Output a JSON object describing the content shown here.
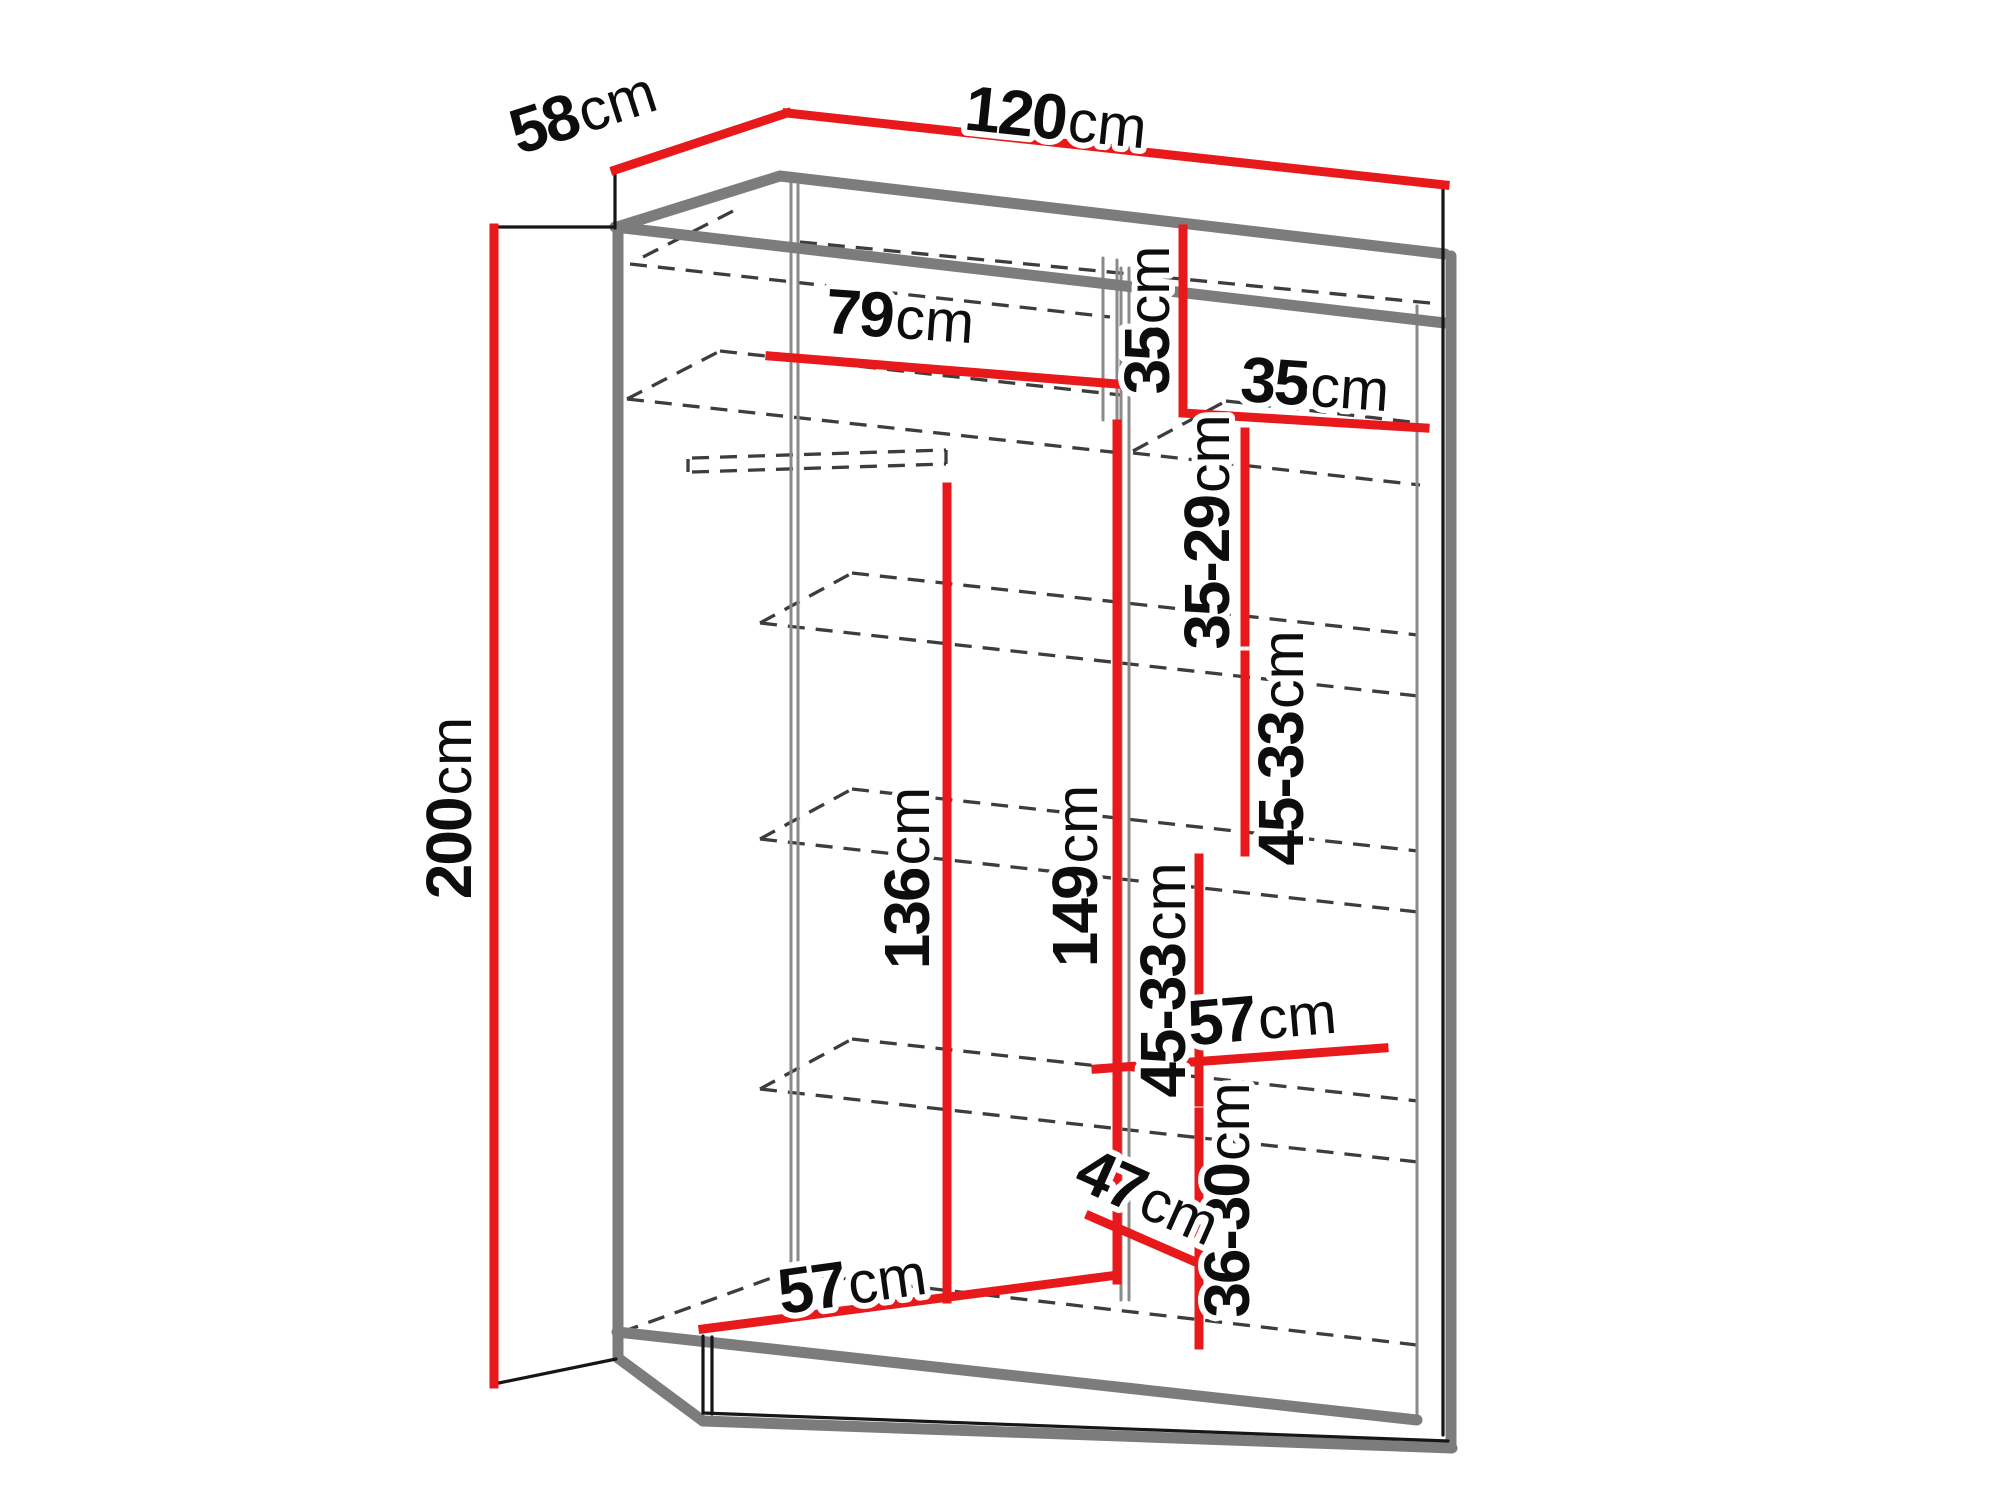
{
  "diagram": {
    "name": "wardrobe-dimension-diagram",
    "unit": "cm",
    "colors": {
      "dimension_red": "#e8191b",
      "outline_black": "#161616",
      "panel_gray": "#7c7c7c",
      "hidden_line_dash": "#3d3d3d",
      "background": "#ffffff"
    },
    "overall": {
      "width": "120",
      "depth": "58",
      "height": "200"
    },
    "labels": [
      {
        "id": "depth-top",
        "value": "58",
        "unit": "cm"
      },
      {
        "id": "width-top",
        "value": "120",
        "unit": "cm"
      },
      {
        "id": "height-left",
        "value": "200",
        "unit": "cm"
      },
      {
        "id": "left-section-width",
        "value": "79",
        "unit": "cm"
      },
      {
        "id": "top-cubby-height",
        "value": "35",
        "unit": "cm"
      },
      {
        "id": "top-cubby-width",
        "value": "35",
        "unit": "cm"
      },
      {
        "id": "right-gap-1",
        "value": "35-29",
        "unit": "cm"
      },
      {
        "id": "right-gap-2",
        "value": "45-33",
        "unit": "cm"
      },
      {
        "id": "hanging-height",
        "value": "136",
        "unit": "cm"
      },
      {
        "id": "interior-height",
        "value": "149",
        "unit": "cm"
      },
      {
        "id": "right-gap-3",
        "value": "45-33",
        "unit": "cm"
      },
      {
        "id": "shelf-depth",
        "value": "57",
        "unit": "cm"
      },
      {
        "id": "right-gap-4",
        "value": "36-30",
        "unit": "cm"
      },
      {
        "id": "bottom-diagonal",
        "value": "47",
        "unit": "cm"
      },
      {
        "id": "floor-depth",
        "value": "57",
        "unit": "cm"
      }
    ]
  }
}
